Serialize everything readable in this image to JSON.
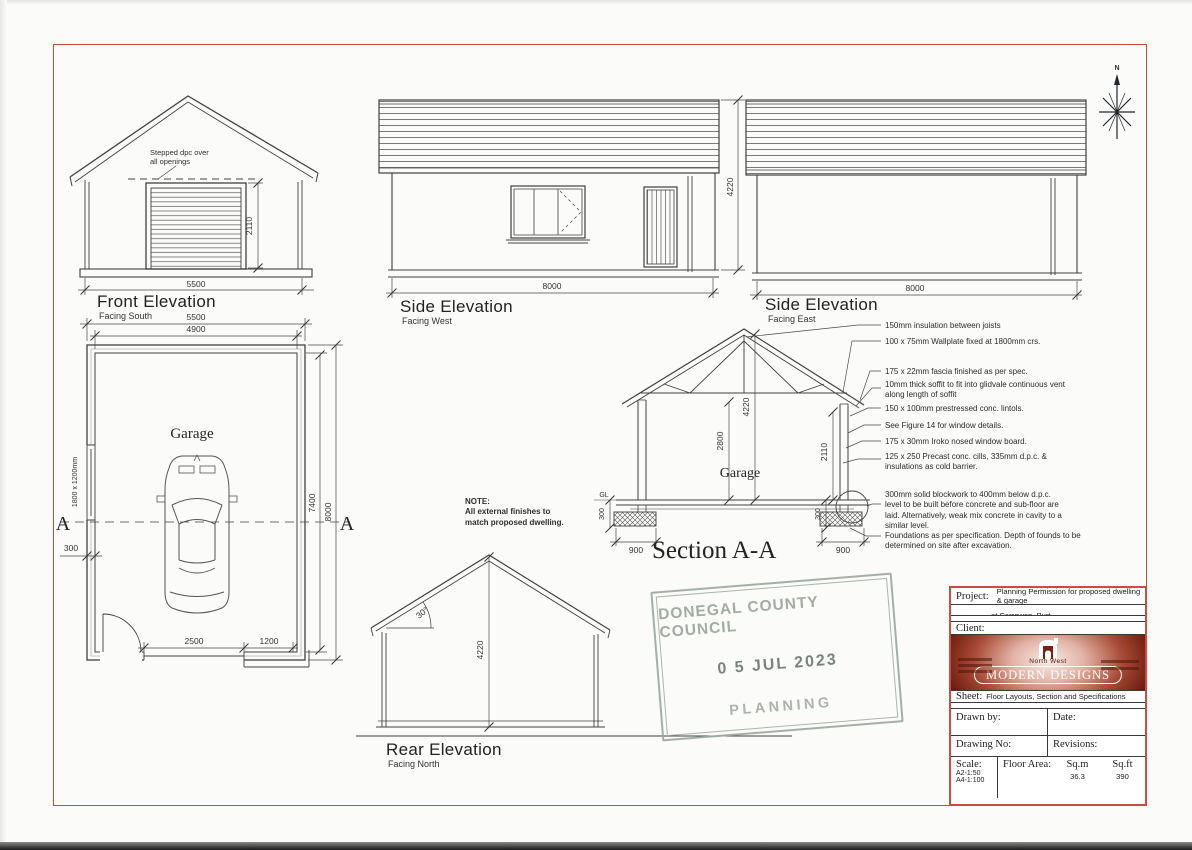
{
  "compass": {
    "north": "N"
  },
  "front": {
    "title": "Front Elevation",
    "facing": "Facing South",
    "dpc_note": "Stepped dpc over\nall openings",
    "dim_width": "5500",
    "dim_door": "2110"
  },
  "west": {
    "title": "Side Elevation",
    "facing": "Facing West",
    "dim_width": "8000",
    "dim_height": "4220"
  },
  "east": {
    "title": "Side Elevation",
    "facing": "Facing East",
    "dim_width": "8000"
  },
  "plan": {
    "label": "Garage",
    "dim_top_outer": "5500",
    "dim_top_inner": "4900",
    "dim_right_inner": "7400",
    "dim_right_outer": "8000",
    "window_label": "1800 x 1200mm",
    "dim_wall": "300",
    "dim_opening": "2500",
    "dim_pier": "1200",
    "marker_left": "A",
    "marker_right": "A"
  },
  "rear": {
    "title": "Rear Elevation",
    "facing": "Facing North",
    "dim_height": "4220",
    "pitch": "30°"
  },
  "section": {
    "title": "Section A-A",
    "label": "Garage",
    "dim_apex": "4220",
    "dim_wall": "2800",
    "dim_door": "2110",
    "gl": "GL",
    "dim_left_300": "300",
    "dim_right_300": "300",
    "dim_left_900": "900",
    "dim_right_900": "900"
  },
  "site_note": {
    "heading": "NOTE:",
    "body": "All external finishes to match proposed dwelling."
  },
  "notes": [
    "150mm insulation between joists",
    "100 x 75mm Wallplate fixed at 1800mm crs.",
    "175 x 22mm fascia finished as per spec.",
    "10mm thick soffit to fit into glidvale continuous vent along length of soffit",
    "150 x 100mm prestressed conc. lintols.",
    "See Figure 14 for window details.",
    "175 x 30mm Iroko nosed window board.",
    "125 x 250 Precast conc. cills, 335mm d.p.c. & insulations as cold barrier.",
    "300mm solid blockwork to 400mm below d.p.c. level to be built before concrete and sub-floor are laid. Alternatively, weak mix concrete in cavity to a similar level.",
    "Foundations as per specification. Depth of founds to be determined on site after excavation."
  ],
  "stamp": {
    "council": "DONEGAL COUNTY COUNCIL",
    "date": "0 5  JUL  2023",
    "dept": "PLANNING"
  },
  "titleblock": {
    "project_label": "Project:",
    "project_line1": "Planning Permission for proposed dwelling & garage",
    "project_line2": "at Carrowen, Burt.",
    "client_label": "Client:",
    "logo_top": "North West",
    "logo_main": "MODERN DESIGNS",
    "sheet_label": "Sheet:",
    "sheet_value": "Floor Layouts, Section and Specifications",
    "drawn_by_label": "Drawn by:",
    "date_label": "Date:",
    "drawing_no_label": "Drawing No:",
    "revisions_label": "Revisions:",
    "scale_label": "Scale:",
    "scale_line1": "A2-1:50",
    "scale_line2": "A4-1:100",
    "floor_area_label": "Floor Area:",
    "sqm_label": "Sq.m",
    "sqm_value": "36.3",
    "sqft_label": "Sq.ft",
    "sqft_value": "390"
  }
}
